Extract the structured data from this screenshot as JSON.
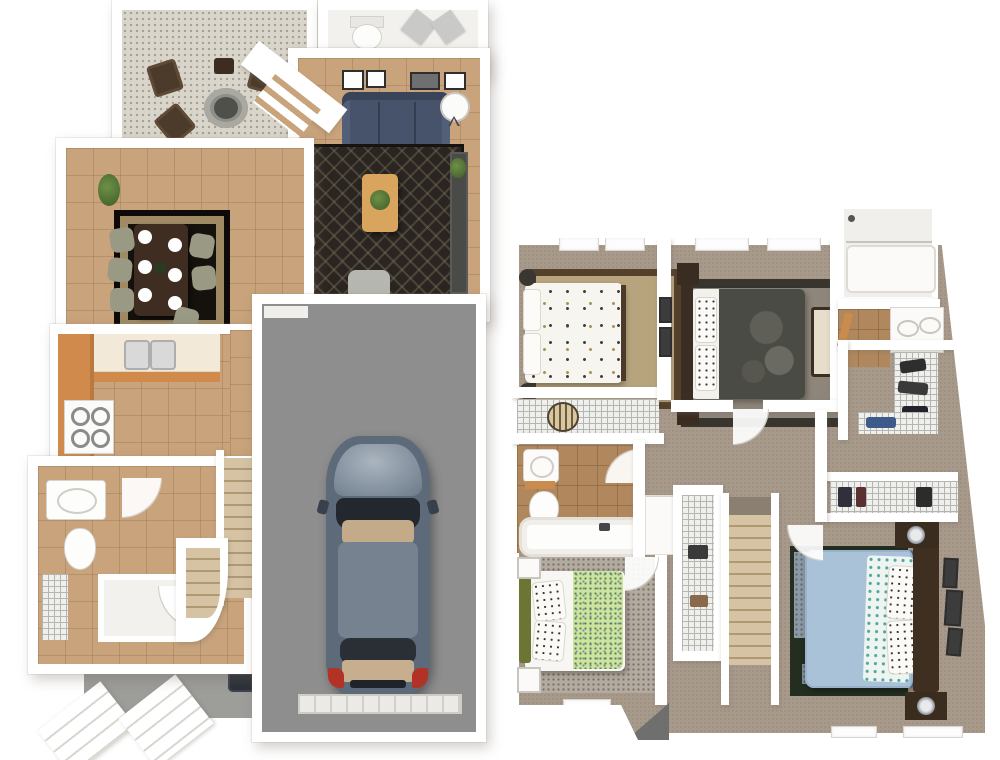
{
  "scene": {
    "type": "3d-floorplan-dollhouse-render",
    "view": "top-down",
    "background": "#ffffff",
    "floor_count": 2,
    "text_labels": []
  },
  "palette": {
    "wall": "#ffffff",
    "wall_shadow": "#d8d4cc",
    "tile_floor": "#c8a37b",
    "bath_tile": "#b1885e",
    "carpet": "#a89a8b",
    "patio_gravel": "#d9d5cb",
    "garage_floor": "#8e8e8e",
    "concrete_walk": "#9d9d9a",
    "cabinet_wood": "#d08a4c",
    "countertop_cream": "#f2e9d8",
    "sofa_navy": "#47536a",
    "living_rug": "#2a2520",
    "dining_rug": "#15110d",
    "dining_table_wood": "#3f2d21",
    "chair_sage": "#9a9a84",
    "coffee_table_wood": "#d8a45e",
    "car_body": "#5c6a79",
    "car_glass": "#23282f",
    "car_interior_tan": "#c3ab8a",
    "taillight_red": "#b33226",
    "stairs_carpet": "#d5c3a4",
    "bed_white": "#f7f5ef",
    "bed1_blanket_gray": "#4b4b45",
    "bed2_rug": "#b7a47d",
    "bed2_rug_border": "#54402b",
    "bed3_runner_green": "#cfe2a0",
    "bed3_headboard_olive": "#6d7535",
    "master_duvet_blue": "#a9c2d8",
    "master_trim_navy": "#3a5a8c",
    "master_rug_green": "#232e20",
    "dark_wood": "#3f2f20",
    "wire_shelf": "#efefec",
    "plant_green": "#4c7033"
  },
  "floors": [
    {
      "name": "first-floor",
      "position": "left",
      "rooms": [
        {
          "name": "patio",
          "floor": "gravel",
          "furniture": [
            "outdoor-chair",
            "outdoor-chair",
            "outdoor-chair",
            "outdoor-chair",
            "fire-pit",
            "side-table",
            "hedge-planter"
          ]
        },
        {
          "name": "entry-foyer",
          "floor": "white",
          "furniture": [
            "toilet",
            "entry-doors"
          ]
        },
        {
          "name": "living-room",
          "floor": "tile",
          "furniture": [
            "sofa-navy",
            "geometric-area-rug",
            "coffee-table",
            "potted-plant",
            "armchair",
            "armchair",
            "round-side-table",
            "media-console",
            "wall-art",
            "wall-art",
            "wall-art",
            "wall-art",
            "slatted-window-wall"
          ]
        },
        {
          "name": "dining-room",
          "floor": "tile",
          "furniture": [
            "dining-table",
            "dining-chair",
            "dining-chair",
            "dining-chair",
            "dining-chair",
            "dining-chair",
            "dining-chair",
            "place-settings-6",
            "area-rug",
            "potted-plant"
          ]
        },
        {
          "name": "kitchen",
          "floor": "tile",
          "furniture": [
            "wood-cabinet-run",
            "counter-with-double-sink",
            "range-stove"
          ]
        },
        {
          "name": "powder-room-hall",
          "floor": "tile",
          "furniture": [
            "vanity-sink",
            "toilet",
            "wire-shelf-closet"
          ]
        },
        {
          "name": "staircase",
          "floor": "carpet-steps",
          "furniture": [
            "stair-run",
            "curved-landing"
          ]
        },
        {
          "name": "garage",
          "floor": "concrete-gray",
          "furniture": [
            "car",
            "garage-door"
          ]
        },
        {
          "name": "exterior",
          "floor": "concrete",
          "furniture": [
            "front-walk",
            "porch-steps",
            "porch-steps",
            "utility-unit"
          ]
        }
      ]
    },
    {
      "name": "second-floor",
      "position": "right",
      "rooms": [
        {
          "name": "bedroom-2",
          "floor": "carpet",
          "furniture": [
            "bed-white-dotted",
            "bordered-area-rug",
            "table-lamp",
            "table-lamp",
            "window",
            "window"
          ]
        },
        {
          "name": "bedroom-2-closet",
          "floor": "carpet",
          "furniture": [
            "wire-shelf",
            "round-basket"
          ]
        },
        {
          "name": "bedroom-1",
          "floor": "carpet",
          "furniture": [
            "bed-gray-floral",
            "dark-area-rug",
            "headboard",
            "bench",
            "wall-art",
            "wall-art",
            "window",
            "window"
          ]
        },
        {
          "name": "hall-bathroom",
          "floor": "tile",
          "furniture": [
            "vanity-sink",
            "toilet",
            "bathtub"
          ]
        },
        {
          "name": "bathroom-2",
          "floor": "white",
          "furniture": [
            "shower-tub",
            "double-sink-vanity"
          ]
        },
        {
          "name": "walk-in-closet",
          "floor": "carpet",
          "furniture": [
            "wire-shelving",
            "clothes"
          ]
        },
        {
          "name": "master-closet",
          "floor": "carpet",
          "furniture": [
            "wire-shelving",
            "clothes"
          ]
        },
        {
          "name": "master-bedroom",
          "floor": "carpet",
          "furniture": [
            "bed-blue",
            "area-rug",
            "headboard",
            "nightstand",
            "nightstand",
            "lamp",
            "lamp",
            "wall-art-set",
            "window",
            "window"
          ]
        },
        {
          "name": "bedroom-3",
          "floor": "carpet",
          "furniture": [
            "bed-green-white",
            "speckled-area-rug",
            "olive-headboard",
            "nightstand",
            "nightstand",
            "window"
          ]
        },
        {
          "name": "linen-closet",
          "floor": "carpet",
          "furniture": [
            "wire-shelving"
          ]
        },
        {
          "name": "hallway",
          "floor": "carpet",
          "furniture": [
            "white-cabinet"
          ]
        },
        {
          "name": "staircase",
          "floor": "carpet-steps",
          "furniture": [
            "stair-run"
          ]
        }
      ]
    }
  ]
}
